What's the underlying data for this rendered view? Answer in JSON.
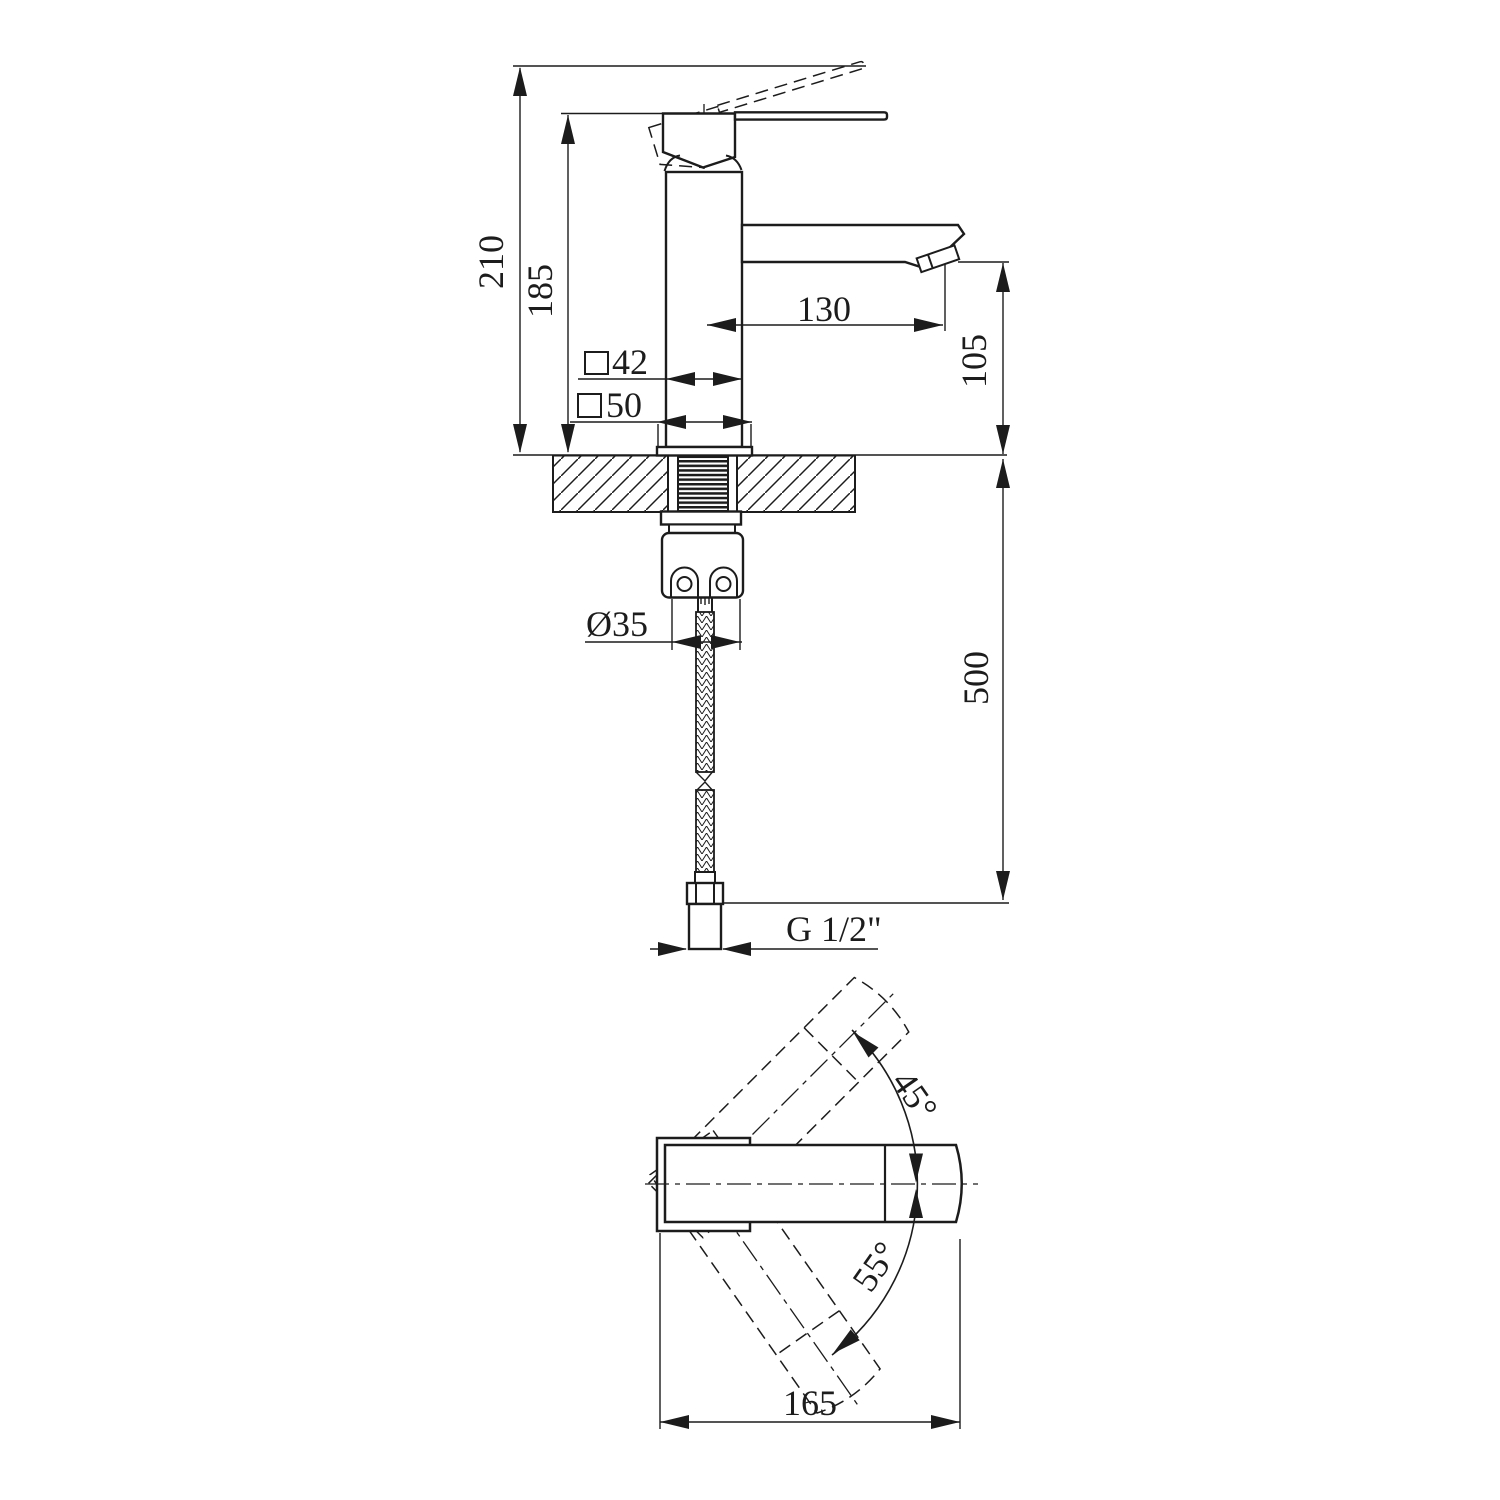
{
  "drawing": {
    "product": "single-lever basin mixer technical drawing",
    "views": {
      "front": {
        "dims": {
          "total_height": "210",
          "body_height": "185",
          "spout_reach": "130",
          "spout_height": "105",
          "body_square": "42",
          "base_square": "50",
          "hole_diameter": "Ø35",
          "hose_length": "500",
          "thread": "G 1/2\""
        }
      },
      "top": {
        "dims": {
          "handle_length": "165",
          "swing_up": "45°",
          "swing_down": "55°"
        }
      }
    }
  }
}
